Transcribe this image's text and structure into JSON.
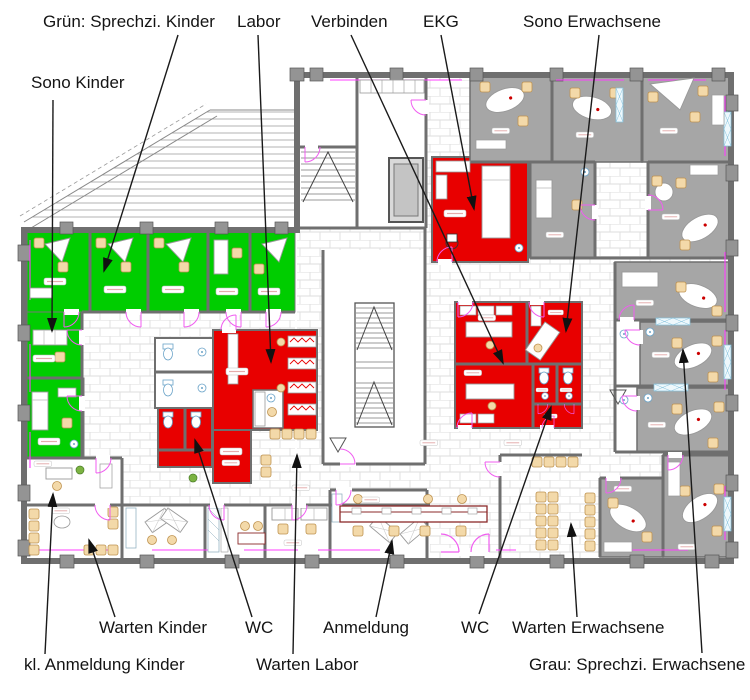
{
  "labels": {
    "gruen_kinder": "Grün: Sprechzi. Kinder",
    "labor": "Labor",
    "verbinden": "Verbinden",
    "ekg": "EKG",
    "sono_erwachsene": "Sono Erwachsene",
    "sono_kinder": "Sono Kinder",
    "warten_kinder": "Warten Kinder",
    "wc_links": "WC",
    "anmeldung": "Anmeldung",
    "wc_rechts": "WC",
    "warten_erwachsene": "Warten Erwachsene",
    "kl_anmeldung_kinder": "kl. Anmeldung Kinder",
    "warten_labor": "Warten Labor",
    "grau_erwachsene": "Grau: Sprechzi. Erwachsene"
  },
  "colors": {
    "kinder_rooms_green": "#00cd00",
    "funktions_rooms_red": "#e80000",
    "erwachsene_rooms_gray": "#a6a6a6",
    "walls": "#6f6f6f",
    "door_arcs_magenta": "#f05df0",
    "chairs_tan": "#f3d9a9",
    "counter_maroon": "#8b2a2a"
  }
}
